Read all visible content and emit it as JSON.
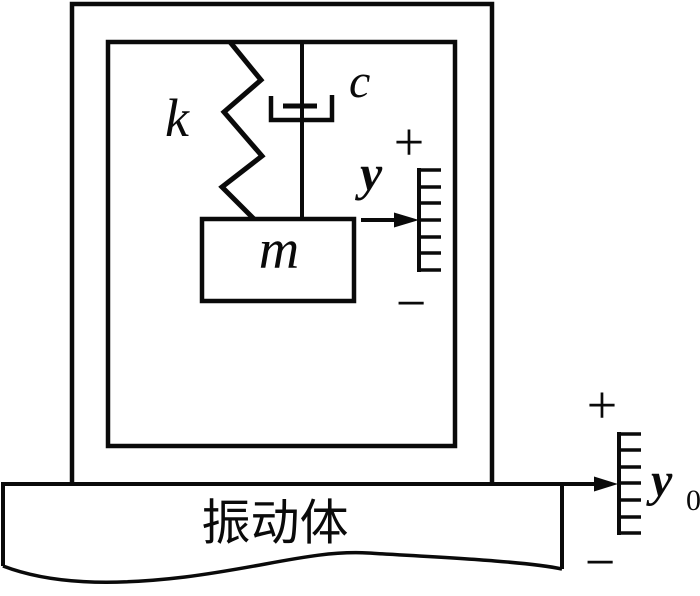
{
  "figure": {
    "description": "Schematic of a seismic vibration measuring instrument: mass m suspended by spring k and damper c inside a double-walled case that rests on a vibrating body",
    "background_color": "#ffffff",
    "line_color": "#0a0a0a"
  },
  "components": {
    "spring_label": "k",
    "damper_label": "c",
    "mass_label": "m",
    "vibrating_body_label": "振动体"
  },
  "mass_scale": {
    "label": "y",
    "plus": "+",
    "minus": "−",
    "tick_count": 7
  },
  "base_scale": {
    "label_base": "y",
    "label_subscript": "0",
    "plus": "+",
    "minus": "−",
    "tick_count": 7
  }
}
